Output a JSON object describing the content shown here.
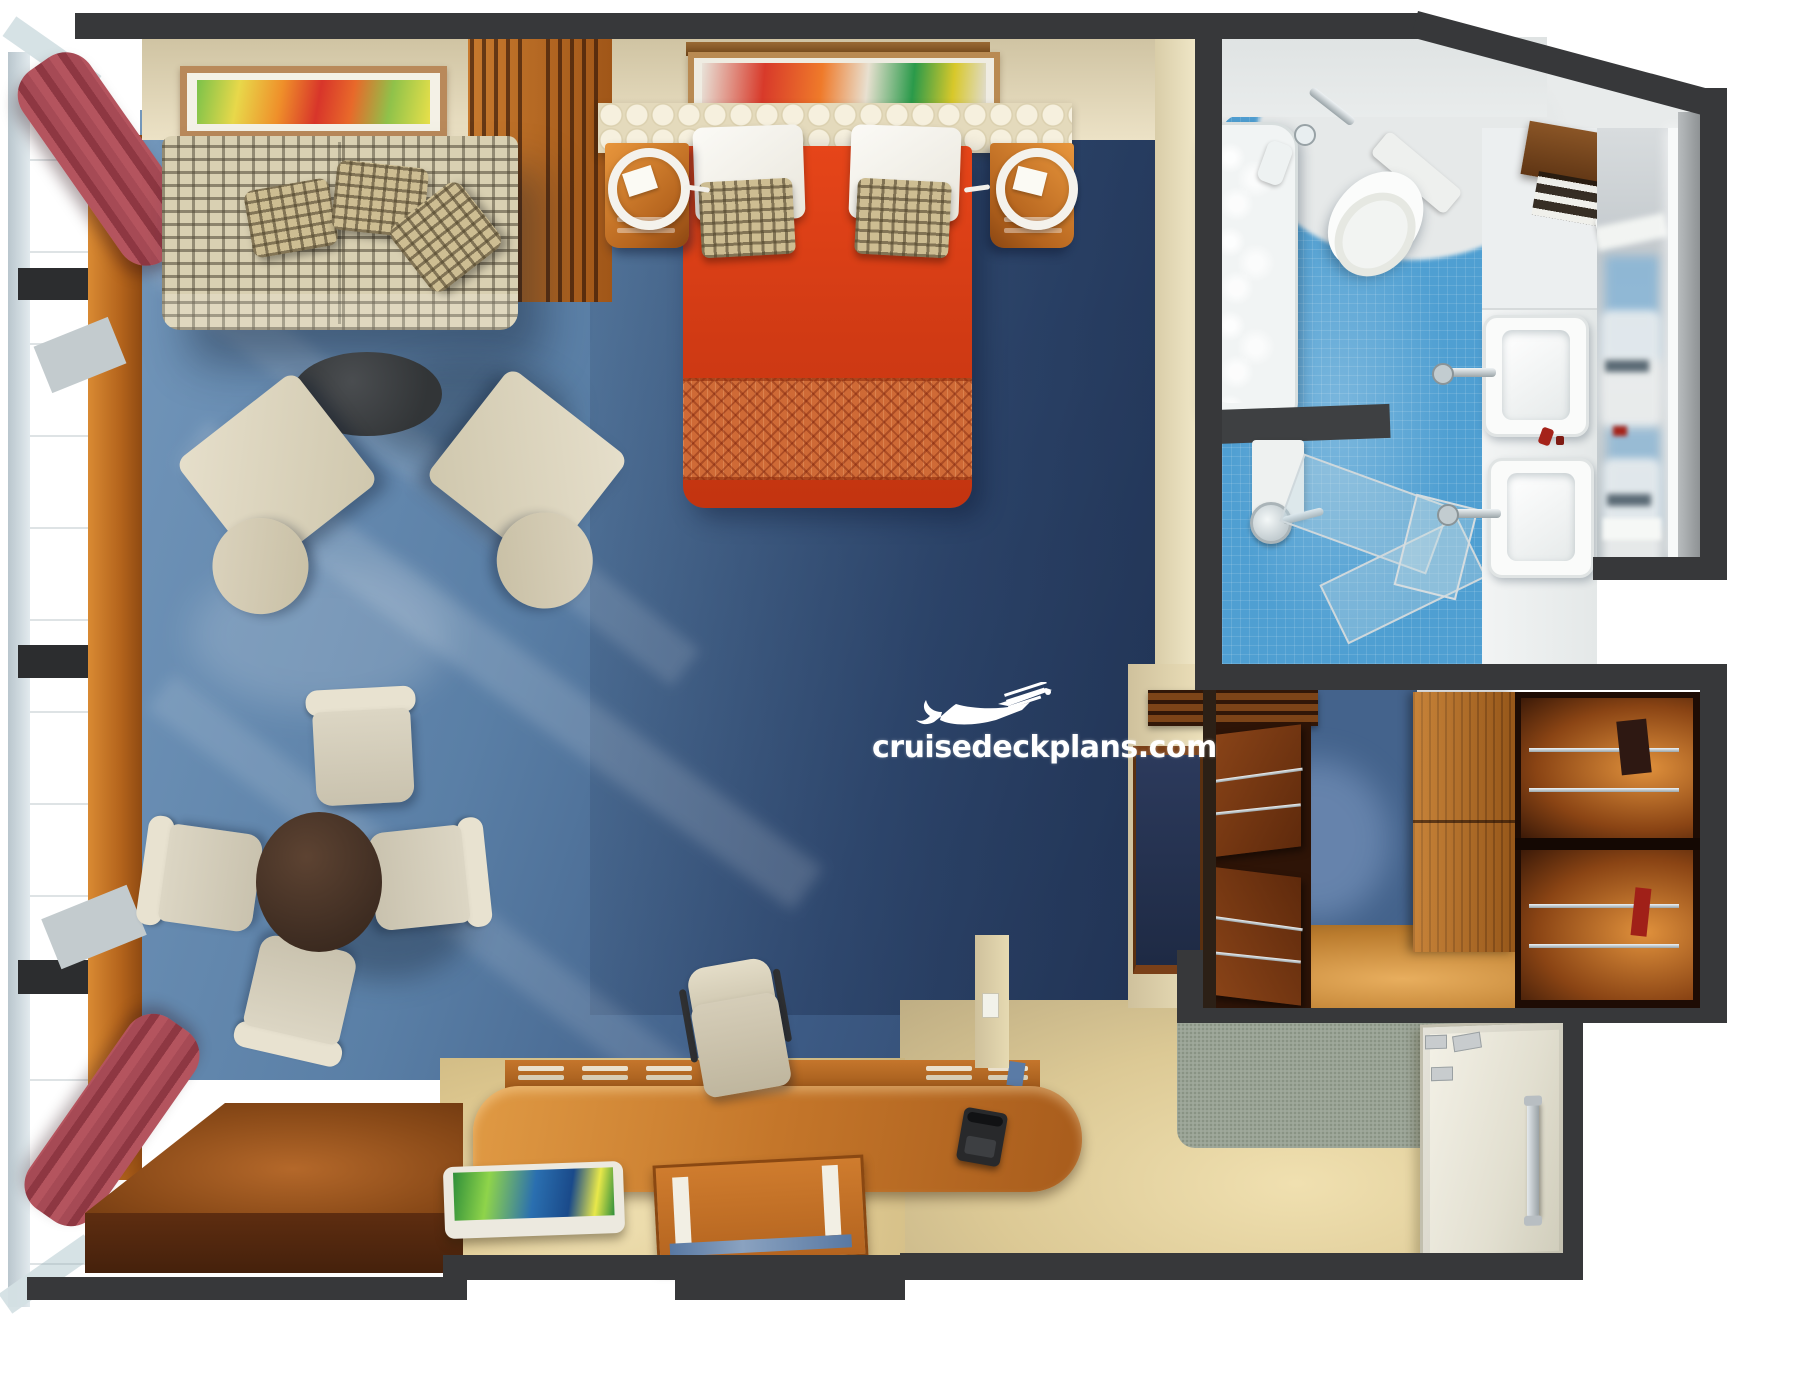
{
  "watermark": {
    "text": "cruisedeckplans.com",
    "icon": "cruise-ship-logo",
    "color": "#ffffff"
  },
  "floorplan": {
    "type": "cruise-ship-suite-top-down-3d-render",
    "rooms": [
      {
        "name": "living-area",
        "floor": "blue-carpet"
      },
      {
        "name": "bedroom",
        "floor": "dark-blue-carpet"
      },
      {
        "name": "bathroom",
        "floor": "blue-tile"
      },
      {
        "name": "walk-in-closet",
        "floor": "wood"
      },
      {
        "name": "entry-hall",
        "floor": "beige-and-gray-carpet"
      },
      {
        "name": "balcony-window-wall",
        "floor": "glass"
      }
    ],
    "furniture": [
      "patterned-sofa",
      "sofa-pillows",
      "oval-coffee-table",
      "armchair-left",
      "armchair-right",
      "round-dining-table",
      "dining-chairs-x4",
      "double-bed-red-cover",
      "white-pillows",
      "accent-pillows",
      "scalloped-headboard",
      "nightstand-left",
      "nightstand-right",
      "ring-lamps",
      "art-frame-sofa",
      "art-frame-bed",
      "slatted-cabinet",
      "tv-panel",
      "louvered-vent",
      "desk-console",
      "desk-chair",
      "telephone",
      "writing-mat",
      "picture-tray",
      "wood-platform",
      "bathtub",
      "toilet",
      "shower-glass",
      "shower-head",
      "double-sinks",
      "mirror-led",
      "towel-shelf",
      "wardrobe-units",
      "sliding-wood-panel",
      "closet-shelf-bays",
      "entry-door",
      "curtain-top-left",
      "curtain-bottom-left"
    ],
    "palette": {
      "wall": "#37383a",
      "carpet_living": "#55799f",
      "carpet_bedroom": "#32496e",
      "bed_cover": "#d83a14",
      "bed_foot_band": "#cf6a36",
      "sofa_fabric": "#d9d0b2",
      "sofa_pattern": "#4e4634",
      "wood_cherry": "#c4762a",
      "wood_dark": "#5f2a0c",
      "curtain": "#a64a55",
      "bath_tile": "#4f9fd2",
      "tub_water": "#a8d8e8",
      "entry_floor": "#e0cd9c",
      "hall_carpet": "#9fa89b",
      "glow_closet": "#e0913c",
      "glass": "#d4e0e6"
    }
  }
}
